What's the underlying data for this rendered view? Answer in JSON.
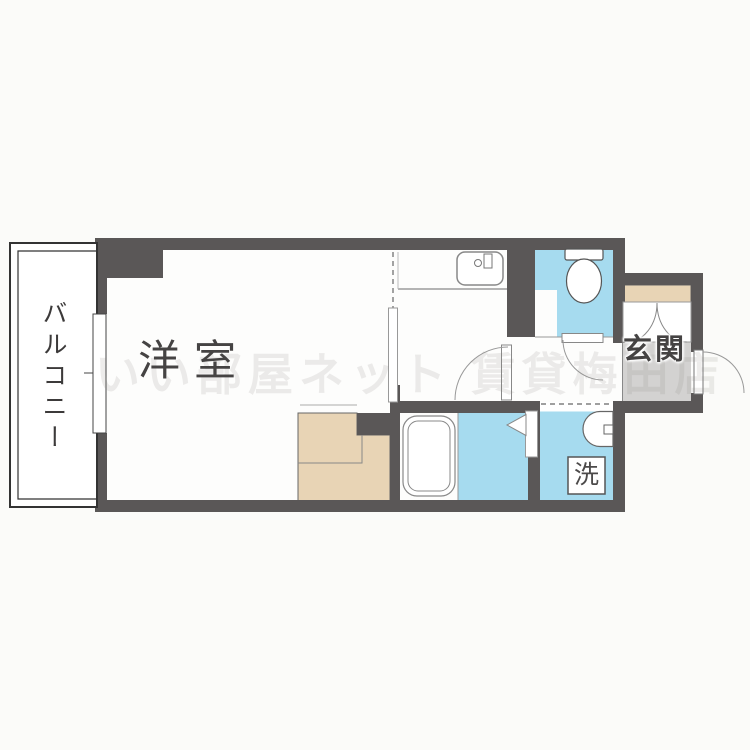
{
  "colors": {
    "wall": "#5a5757",
    "blue": "#a6dbef",
    "beige": "#e8d4b5",
    "gray": "#d3d2d1",
    "floor": "#fdfdfc",
    "bg": "#fbfbf9",
    "text": "#454343"
  },
  "rooms": {
    "balcony": {
      "label": "バルコニー"
    },
    "western_room": {
      "label": "洋室"
    },
    "entrance": {
      "label": "玄関"
    }
  },
  "fixtures": {
    "washing_machine": {
      "label": "洗"
    },
    "icons": [
      "kitchen-sink-icon",
      "toilet-icon",
      "bathtub-icon",
      "washbasin-icon",
      "door-swing-icon",
      "double-door-icon",
      "folding-door-icon",
      "window-icon"
    ]
  },
  "watermark": {
    "text": "いい部屋ネット 賃貸梅田店"
  }
}
